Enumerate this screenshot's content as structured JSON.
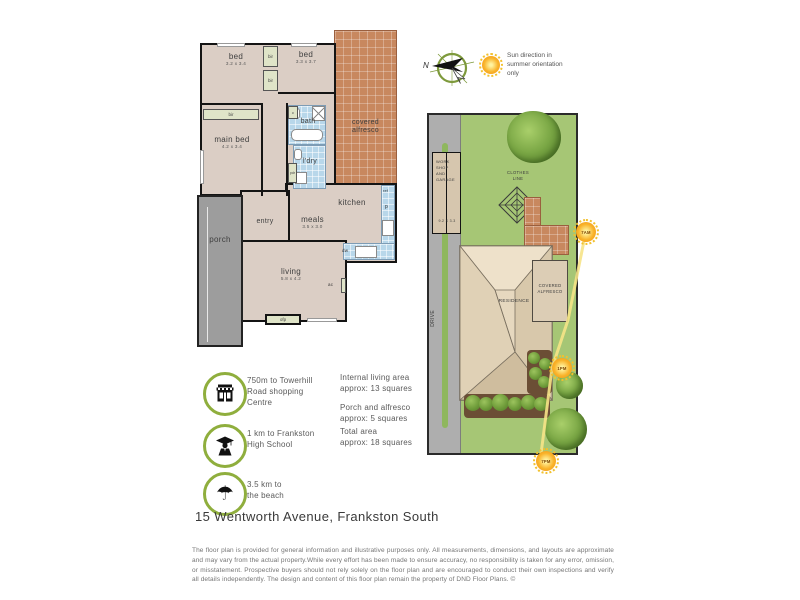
{
  "page": {
    "address": "15 Wentworth Avenue, Frankston South",
    "disclaimer": "The floor plan is provided for general information and illustrative purposes only. All measurements, dimensions, and layouts are approximate and may vary from the actual property.While every effort has been made to ensure accuracy, no responsibility is taken for any error, omission, or misstatement. Prospective buyers should not rely solely on the floor plan and are encouraged to conduct their own inspections and verify all details independently. The design and content of this floor plan remain the property of DND Floor Plans. ©"
  },
  "legend": {
    "north_label": "N",
    "sun_note": "Sun direction in\nsummer orientation\nonly"
  },
  "floorplan": {
    "rooms": {
      "bed1": {
        "name": "bed",
        "dims": "3.2 x 3.4"
      },
      "bed2": {
        "name": "bed",
        "dims": "3.3 x 3.7"
      },
      "main_bed": {
        "name": "main bed",
        "dims": "4.2 x 3.4"
      },
      "bath": {
        "name": "bath"
      },
      "laundry": {
        "name": "l'dry"
      },
      "alfresco": {
        "name": "covered\nalfresco"
      },
      "kitchen": {
        "name": "kitchen"
      },
      "meals": {
        "name": "meals",
        "dims": "3.5 x 3.0"
      },
      "living": {
        "name": "living",
        "dims": "5.8 x 4.2"
      },
      "entry": {
        "name": "entry"
      },
      "porch": {
        "name": "porch"
      }
    },
    "fixtures": {
      "robe": "bir",
      "cupboard": "c",
      "powder": "pdr",
      "fridge": "ref",
      "pantry": "p",
      "dishwasher": "dw",
      "aircon": "ac",
      "fireplace": "ofp"
    }
  },
  "siteplan": {
    "workshop_name": "WORK\nSHOP\nAND\nGARAGE",
    "workshop_dims": "9.2 X 3.3",
    "clothes_line": "CLOTHES\nLINE",
    "residence": "RESIDENCE",
    "covered_alfresco": "COVERED\nALFRESCO",
    "drive": "DRIVE",
    "suns": {
      "am7": "7AM",
      "pm1": "1PM",
      "pm7": "7PM"
    }
  },
  "amenities": [
    {
      "icon": "shop-icon",
      "text": "750m to Towerhill\nRoad shopping\nCentre"
    },
    {
      "icon": "school-icon",
      "text": "1 km to Frankston\nHigh School"
    },
    {
      "icon": "beach-icon",
      "text": "3.5 km to\nthe beach"
    }
  ],
  "areas": [
    {
      "text": "Internal living area\napprox: 13 squares"
    },
    {
      "text": "Porch and alfresco\napprox: 5 squares"
    },
    {
      "text": "Total area\napprox: 18 squares"
    }
  ],
  "colors": {
    "floor": "#dbcec5",
    "wet": "#b8d7ea",
    "terracotta": "#c8885f",
    "porch": "#9d9d9d",
    "robe": "#dfe4c8",
    "lawn": "#a6c675",
    "drive": "#aeaeae",
    "roof": "#e8dbc3",
    "accent": "#8fae3d",
    "sun": "#f6b62a",
    "wall": "#141414"
  }
}
